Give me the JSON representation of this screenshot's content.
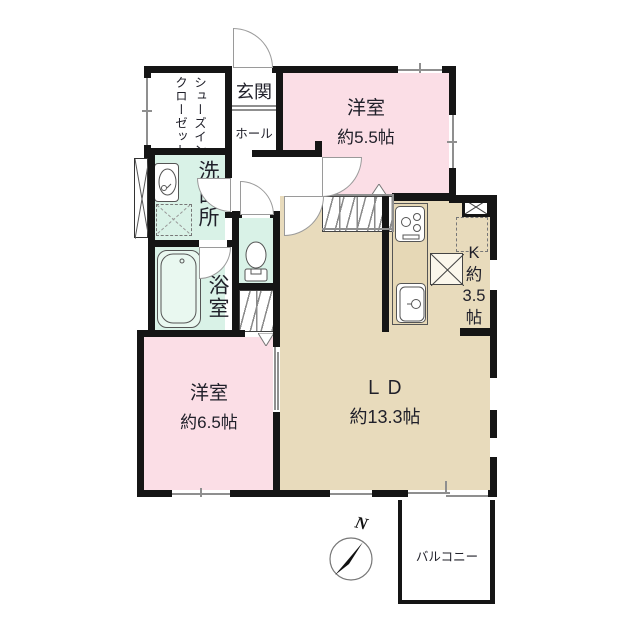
{
  "plan": {
    "rooms": {
      "entrance": {
        "label": "玄関"
      },
      "hall": {
        "label": "ホール"
      },
      "shoes_closet": {
        "label_line1": "シューズイン",
        "label_line2": "クローゼット"
      },
      "washroom": {
        "label": "洗面所"
      },
      "bathroom": {
        "label": "浴室"
      },
      "western_room_1": {
        "label": "洋室",
        "size": "約5.5帖"
      },
      "western_room_2": {
        "label": "洋室",
        "size": "約6.5帖"
      },
      "living_dining": {
        "label": "ＬＤ",
        "size": "約13.3帖"
      },
      "kitchen": {
        "label_k": "K",
        "label_approx": "約",
        "label_size": "3.5",
        "label_unit": "帖"
      },
      "balcony": {
        "label": "バルコニー"
      }
    },
    "compass": {
      "north_label": "N"
    },
    "colors": {
      "room_pink": "#fbdee6",
      "room_mint": "#d9f2e7",
      "room_tan": "#e8dbbc",
      "wall_black": "#151515"
    }
  }
}
